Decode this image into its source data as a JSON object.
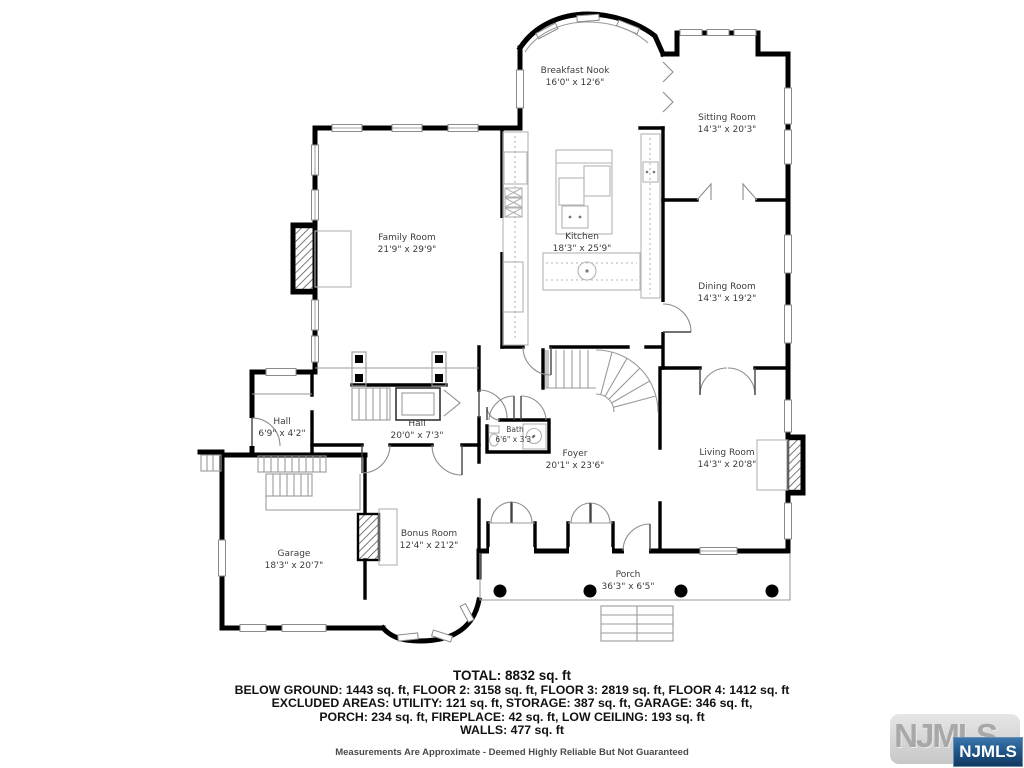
{
  "colors": {
    "wall": "#000000",
    "label": "#3c3c3c",
    "badge_blue": "#1e5183"
  },
  "rooms": [
    {
      "name": "Breakfast Nook",
      "dims": "16'0\" x 12'6\""
    },
    {
      "name": "Sitting Room",
      "dims": "14'3\" x 20'3\""
    },
    {
      "name": "Family Room",
      "dims": "21'9\" x 29'9\""
    },
    {
      "name": "Kitchen",
      "dims": "18'3\" x 25'9\""
    },
    {
      "name": "Dining Room",
      "dims": "14'3\" x 19'2\""
    },
    {
      "name": "Hall",
      "dims": "6'9\" x 4'2\""
    },
    {
      "name": "Hall",
      "dims": "20'0\" x 7'3\""
    },
    {
      "name": "Bath",
      "dims": "6'6\" x 3'3\""
    },
    {
      "name": "Foyer",
      "dims": "20'1\" x 23'6\""
    },
    {
      "name": "Living Room",
      "dims": "14'3\" x 20'8\""
    },
    {
      "name": "Garage",
      "dims": "18'3\" x 20'7\""
    },
    {
      "name": "Bonus Room",
      "dims": "12'4\" x 21'2\""
    },
    {
      "name": "Porch",
      "dims": "36'3\" x 6'5\""
    }
  ],
  "summary": {
    "total": "TOTAL: 8832 sq. ft",
    "floors": "BELOW GROUND: 1443 sq. ft, FLOOR 2: 3158 sq. ft, FLOOR 3: 2819 sq. ft, FLOOR 4: 1412 sq. ft",
    "excluded1": "EXCLUDED AREAS: UTILITY: 121 sq. ft, STORAGE: 387 sq. ft, GARAGE: 346 sq. ft,",
    "excluded2": "PORCH: 234 sq. ft, FIREPLACE: 42 sq. ft, LOW CEILING: 193 sq. ft",
    "walls": "WALLS: 477 sq. ft",
    "disclaimer": "Measurements Are Approximate - Deemed Highly Reliable But Not Guaranteed"
  },
  "watermark": {
    "logo_text": "NJMLS",
    "badge_text": "NJMLS"
  }
}
